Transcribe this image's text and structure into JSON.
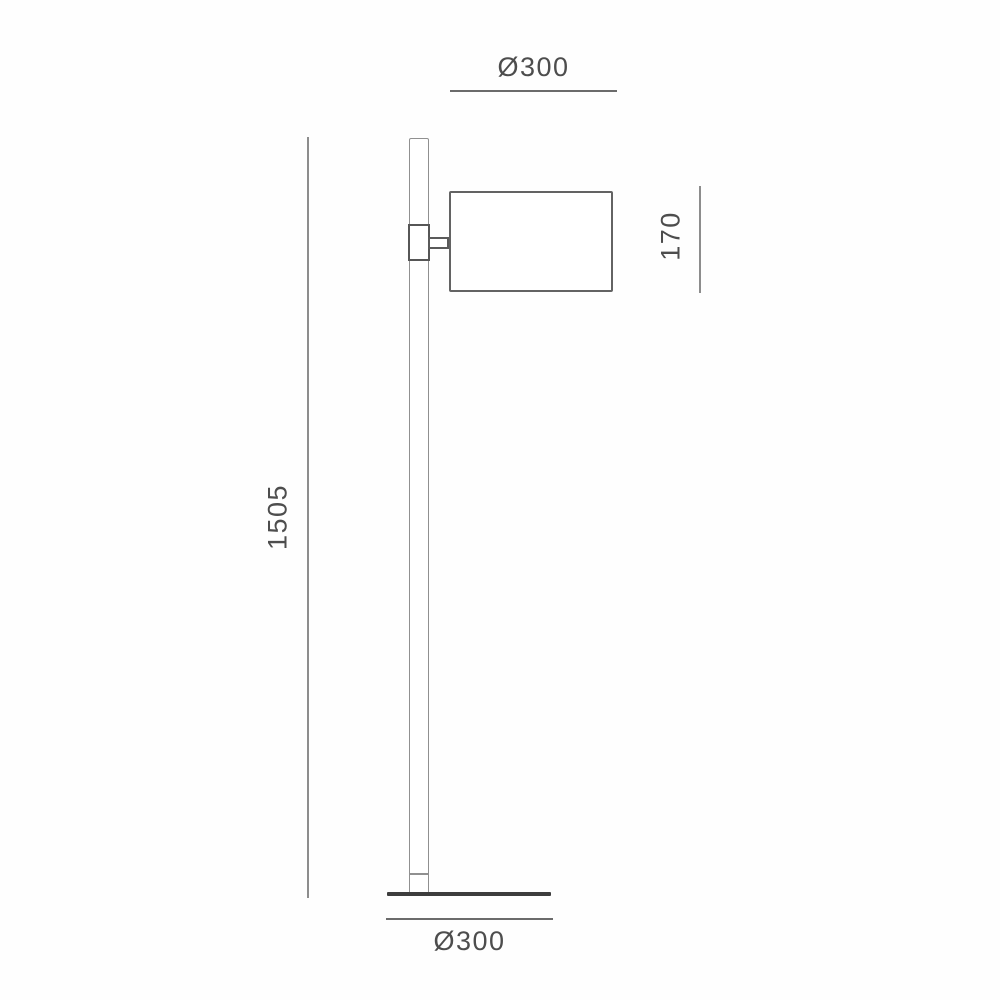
{
  "diagram": {
    "type": "technical-line-drawing",
    "subject": "floor lamp with cylindrical shade, side elevation with dimensions",
    "units": "mm",
    "labels": {
      "shade_diameter": "Ø300",
      "lamp_height": "1505",
      "shade_height": "170",
      "base_diameter": "Ø300"
    },
    "colors": {
      "background": "#fefefe",
      "outline_light": "#909090",
      "outline_dark": "#5a5a5a",
      "dimension_line": "#6b6b6b",
      "base_fill": "#3d3d3d",
      "text": "#4d4d4d"
    }
  }
}
